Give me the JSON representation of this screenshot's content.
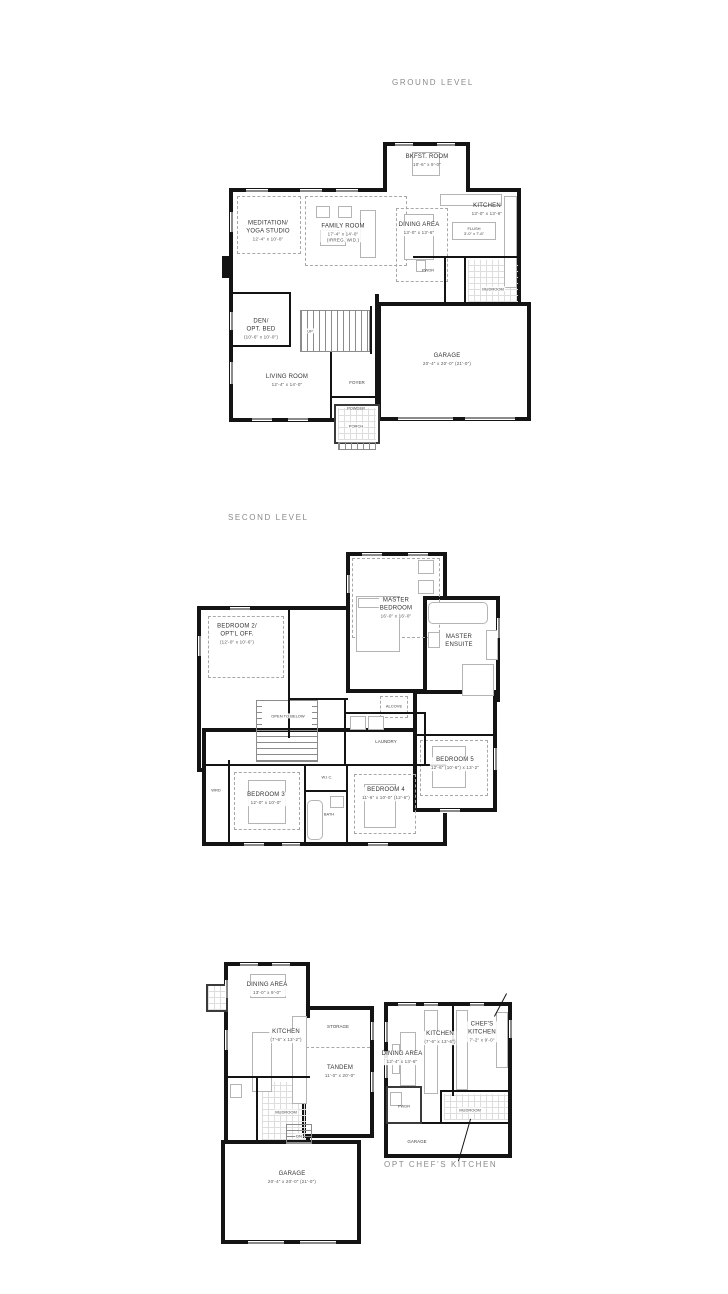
{
  "colors": {
    "wall": "#141414",
    "label": "#333333",
    "dim": "#555555",
    "title": "#8a8a8a"
  },
  "titles": {
    "ground": "GROUND LEVEL",
    "second": "SECOND LEVEL",
    "chefs_option": "OPT CHEF'S KITCHEN"
  },
  "ground": {
    "bkfst": {
      "name": "BKFST. ROOM",
      "dims": "10'-6\" x 9'-0\""
    },
    "kitchen": {
      "name": "KITCHEN",
      "dims": "13'-0\" x 13'-6\""
    },
    "island": {
      "name": "FLUSH",
      "dims": "3'-0\" x 7'-6\""
    },
    "dining": {
      "name": "DINING AREA",
      "dims": "13'-0\" x 13'-6\""
    },
    "family": {
      "name": "FAMILY ROOM",
      "dims": "17'-4\" x 14'-0\"",
      "note": "(IRREG. WID.)"
    },
    "meditation": {
      "l1": "MEDITATION/",
      "l2": "YOGA STUDIO",
      "dims": "12'-4\" x 10'-0\""
    },
    "den": {
      "l1": "DEN/",
      "l2": "OPT. BED",
      "dims": "(10'-6\" x 10'-0\")"
    },
    "living": {
      "name": "LIVING ROOM",
      "dims": "12'-4\" x 14'-0\""
    },
    "garage": {
      "name": "GARAGE",
      "dims": "20'-4\" x 20'-0\" (21'-0\")"
    },
    "foyer": "FOYER",
    "powder": "POWDER",
    "pwdr": "PWDR",
    "mudroom": "MUDROOM",
    "porch": "PORCH",
    "up": "UP"
  },
  "second": {
    "master": {
      "l1": "MASTER",
      "l2": "BEDROOM",
      "dims": "16'-0\" x 16'-0\""
    },
    "ensuite": {
      "l1": "MASTER",
      "l2": "ENSUITE"
    },
    "bed2": {
      "l1": "BEDROOM 2/",
      "l2": "OPT'L OFF.",
      "dims": "(12'-0\" x 10'-6\")"
    },
    "bed3": {
      "name": "BEDROOM 3",
      "dims": "12'-0\" x 10'-0\""
    },
    "bed4": {
      "name": "BEDROOM 4",
      "dims": "11'-6\" x 10'-0\" (12'-6\")"
    },
    "bed5": {
      "name": "BEDROOM 5",
      "dims": "12'-6\" (10'-6\") x 13'-2\""
    },
    "laundry": "LAUNDRY",
    "alcove": "ALCOVE",
    "wic": "W.I.C.",
    "bath": "BATH",
    "wrd": "WRD",
    "open_below": "OPEN TO BELOW"
  },
  "lower": {
    "dining": {
      "name": "DINING AREA",
      "dims": "13'-0\" x 9'-0\""
    },
    "kitchen": {
      "name": "KITCHEN",
      "dims": "(7'-6\" x 13'-2\")"
    },
    "storage": "STORAGE",
    "tandem": {
      "name": "TANDEM",
      "dims": "11'-0\" x 20'-0\""
    },
    "mudroom": "MUDROOM",
    "dn": "DN",
    "garage": {
      "name": "GARAGE",
      "dims": "20'-4\" x 20'-0\" (21'-0\")"
    }
  },
  "chefs": {
    "dining": {
      "name": "DINING AREA",
      "dims": "12'-4\" x 13'-6\""
    },
    "kitchen": {
      "name": "KITCHEN",
      "dims": "(7'-6\" x 13'-6\")"
    },
    "chef": {
      "l1": "CHEF'S",
      "l2": "KITCHEN",
      "dims": "7'-2\" x 9'-0\""
    },
    "pwdr": "PWDR",
    "mudroom": "MUDROOM",
    "garage": "GARAGE"
  }
}
